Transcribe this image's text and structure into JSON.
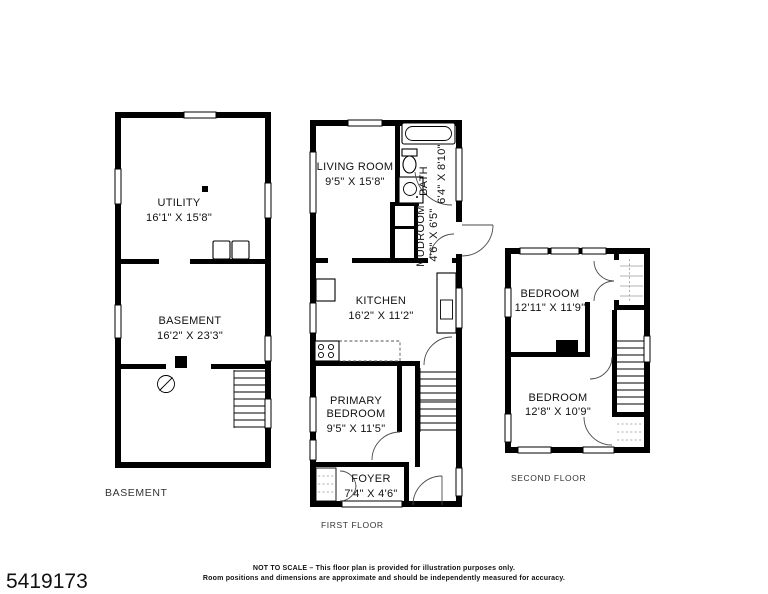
{
  "page": {
    "background": "#ffffff",
    "wall_color": "#000000",
    "text_color": "#111111"
  },
  "listing_id": "5419173",
  "disclaimer": {
    "line1": "NOT TO SCALE – This floor plan is provided for illustration purposes only.",
    "line2": "Room positions and dimensions are approximate and should be independently measured for accuracy."
  },
  "floors": [
    {
      "label": "BASEMENT",
      "rooms": [
        {
          "name": "UTILITY",
          "dims": "16'1\" X 15'8\""
        },
        {
          "name": "BASEMENT",
          "dims": "16'2\" X 23'3\""
        }
      ],
      "fixtures": [
        "washer",
        "dryer",
        "support-post",
        "floor-drain",
        "stairs"
      ]
    },
    {
      "label": "FIRST FLOOR",
      "rooms": [
        {
          "name": "LIVING ROOM",
          "dims": "9'5\" X 15'8\""
        },
        {
          "name": "BATH",
          "dims": "6'4\" X 8'10\""
        },
        {
          "name": "MUDROOM",
          "dims": "4'6\" X 6'5\""
        },
        {
          "name": "KITCHEN",
          "dims": "16'2\" X 11'2\""
        },
        {
          "name": "PRIMARY BEDROOM",
          "name_line1": "PRIMARY",
          "name_line2": "BEDROOM",
          "dims": "9'5\" X 11'5\""
        },
        {
          "name": "FOYER",
          "dims": "7'4\" X 4'6\""
        }
      ],
      "fixtures": [
        "bathtub",
        "toilet",
        "sink",
        "refrigerator",
        "range",
        "kitchen-counter",
        "stairs",
        "closet",
        "entry-door"
      ]
    },
    {
      "label": "SECOND FLOOR",
      "rooms": [
        {
          "name": "BEDROOM",
          "dims": "12'11\" X 11'9\""
        },
        {
          "name": "BEDROOM",
          "dims": "12'8\" X 10'9\""
        }
      ],
      "fixtures": [
        "closet",
        "chimney",
        "stairs",
        "closet"
      ]
    }
  ]
}
